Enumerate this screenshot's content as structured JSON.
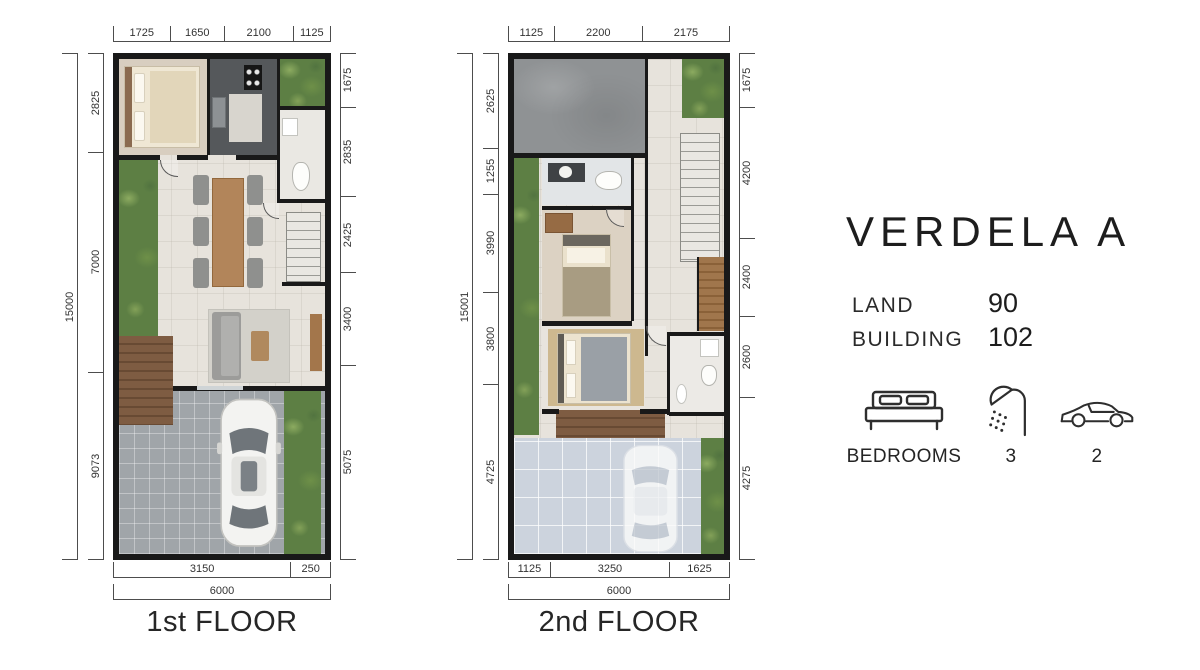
{
  "plans": [
    {
      "name": "1st FLOOR",
      "dims": {
        "top": [
          "1725",
          "1650",
          "2100",
          "1125"
        ],
        "left_total": "15000",
        "left": [
          "2825",
          "7000",
          "9073"
        ],
        "right": [
          "1675",
          "2835",
          "2425",
          "3400",
          "5075"
        ],
        "bottom": [
          "3150",
          "250"
        ],
        "bottom_total": "6000"
      }
    },
    {
      "name": "2nd FLOOR",
      "dims": {
        "top": [
          "1125",
          "2200",
          "2175"
        ],
        "left_total": "15001",
        "left": [
          "2625",
          "1255",
          "3990",
          "3800",
          "4725"
        ],
        "right": [
          "1675",
          "4200",
          "2400",
          "2600",
          "4275"
        ],
        "bottom": [
          "1125",
          "3250",
          "1625"
        ],
        "bottom_total": "6000"
      }
    }
  ],
  "panel": {
    "title": "VERDELA A",
    "specs": [
      {
        "label": "LAND",
        "value": "90"
      },
      {
        "label": "BUILDING",
        "value": "102"
      }
    ],
    "features": [
      {
        "icon": "bed-icon",
        "label": "BEDROOMS"
      },
      {
        "icon": "shower-icon",
        "label": "3"
      },
      {
        "icon": "car-icon",
        "label": "2"
      }
    ]
  },
  "colors": {
    "wall": "#191919",
    "green": "#5d7f44",
    "text": "#222222",
    "background": "#ecebe8"
  }
}
